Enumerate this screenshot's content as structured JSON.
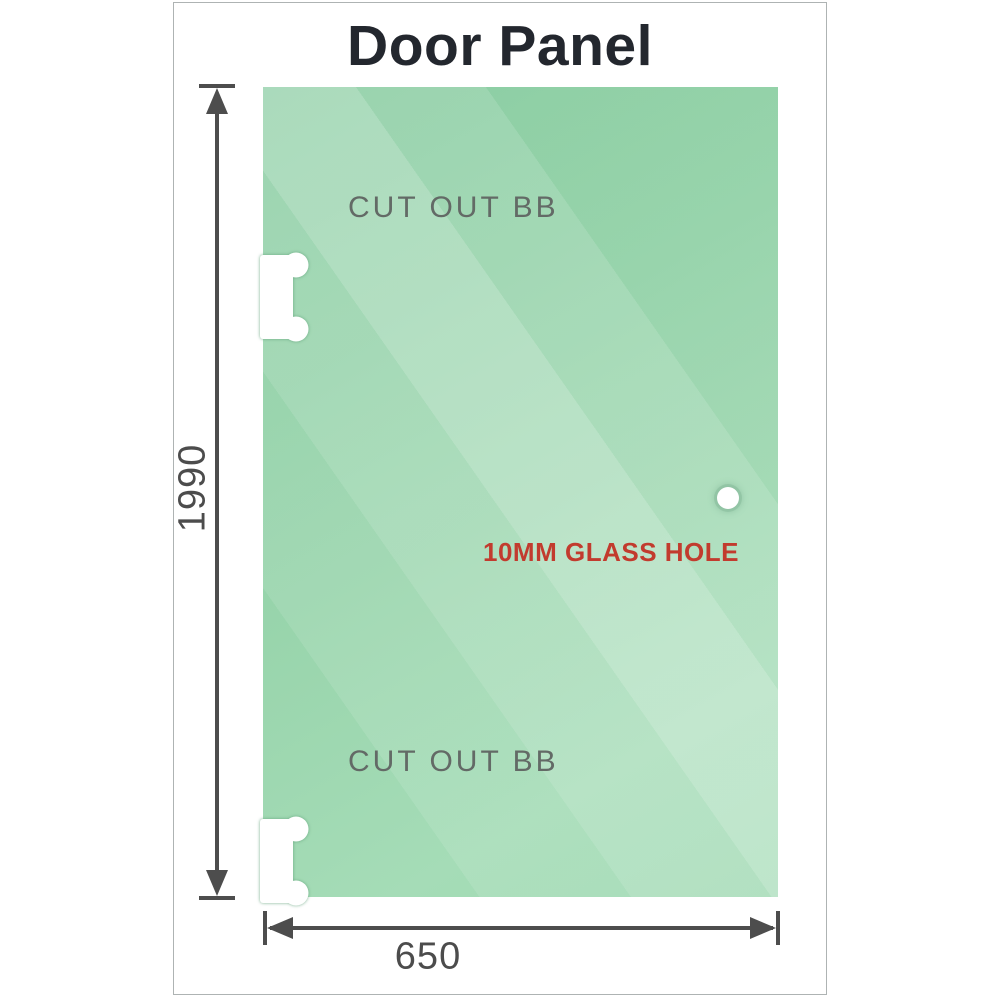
{
  "title": "Door Panel",
  "panel": {
    "top_cutout_label": "CUT OUT BB",
    "bottom_cutout_label": "CUT OUT BB",
    "glass_hole_label": "10MM GLASS HOLE"
  },
  "dimensions": {
    "height_value": "1990",
    "width_value": "650"
  },
  "colors": {
    "glass_base": "#8fd0a5",
    "glass_highlight": "#bde5cd",
    "dimension_line": "#4d4d4d",
    "dimension_text": "#4c4c4c",
    "cutout_label_text": "#636a66",
    "glass_hole_label_text": "#c23b2e",
    "title_text": "#23272e",
    "frame_border": "#aeb3b3",
    "cutout_fill": "#ffffff"
  }
}
